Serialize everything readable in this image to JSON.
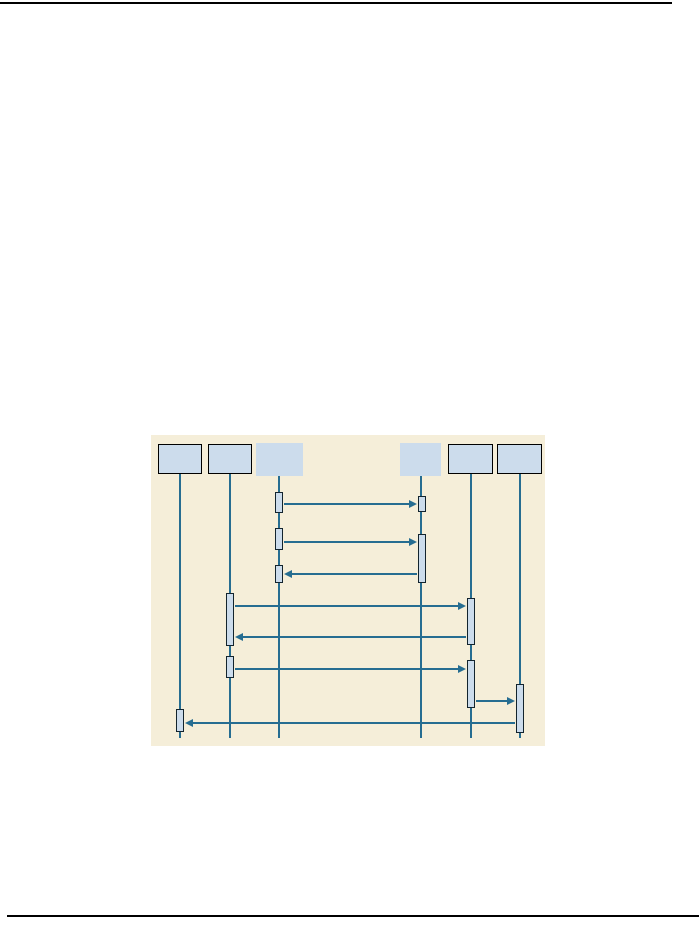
{
  "page": {
    "width": 699,
    "height": 926,
    "background": "#ffffff"
  },
  "page_rules": {
    "top": {
      "x": 0,
      "y": 2,
      "w": 672,
      "h": 2,
      "color": "#000000"
    },
    "bottom": {
      "x": 7,
      "y": 915,
      "w": 692,
      "h": 2,
      "color": "#000000"
    }
  },
  "diagram": {
    "type": "uml-sequence-diagram",
    "panel": {
      "x": 151,
      "y": 435,
      "w": 394,
      "h": 311,
      "bg": "#f5eed9"
    },
    "colors": {
      "box_fill": "#ccdcec",
      "box_border": "#000000",
      "activation_fill": "#ccdcec",
      "activation_border": "#13242e",
      "line": "#266d91"
    },
    "actors": [
      {
        "id": "actor-1",
        "label": "",
        "x": 158,
        "y": 444,
        "w": 44,
        "h": 30,
        "bordered": true
      },
      {
        "id": "actor-2",
        "label": "",
        "x": 208,
        "y": 444,
        "w": 44,
        "h": 30,
        "bordered": true
      },
      {
        "id": "actor-3",
        "label": "",
        "x": 256,
        "y": 443,
        "w": 47,
        "h": 33,
        "bordered": false
      },
      {
        "id": "actor-4",
        "label": "",
        "x": 400,
        "y": 443,
        "w": 41,
        "h": 33,
        "bordered": false
      },
      {
        "id": "actor-5",
        "label": "",
        "x": 448,
        "y": 444,
        "w": 45,
        "h": 30,
        "bordered": true
      },
      {
        "id": "actor-6",
        "label": "",
        "x": 497,
        "y": 444,
        "w": 45,
        "h": 30,
        "bordered": true
      }
    ],
    "lifelines": [
      {
        "actor": 1,
        "x": 180,
        "y1": 474,
        "y2": 738
      },
      {
        "actor": 2,
        "x": 230,
        "y1": 474,
        "y2": 738
      },
      {
        "actor": 3,
        "x": 279,
        "y1": 476,
        "y2": 738
      },
      {
        "actor": 4,
        "x": 421,
        "y1": 476,
        "y2": 738
      },
      {
        "actor": 5,
        "x": 471,
        "y1": 474,
        "y2": 738
      },
      {
        "actor": 6,
        "x": 520,
        "y1": 474,
        "y2": 738
      }
    ],
    "activations": [
      {
        "lifeline": 3,
        "x": 275,
        "y": 492,
        "w": 8,
        "h": 21
      },
      {
        "lifeline": 4,
        "x": 418,
        "y": 496,
        "w": 8,
        "h": 16
      },
      {
        "lifeline": 3,
        "x": 275,
        "y": 528,
        "w": 8,
        "h": 22
      },
      {
        "lifeline": 4,
        "x": 418,
        "y": 534,
        "w": 8,
        "h": 49
      },
      {
        "lifeline": 3,
        "x": 275,
        "y": 565,
        "w": 8,
        "h": 18
      },
      {
        "lifeline": 2,
        "x": 226,
        "y": 593,
        "w": 8,
        "h": 53
      },
      {
        "lifeline": 5,
        "x": 467,
        "y": 598,
        "w": 8,
        "h": 47
      },
      {
        "lifeline": 2,
        "x": 226,
        "y": 656,
        "w": 8,
        "h": 22
      },
      {
        "lifeline": 5,
        "x": 467,
        "y": 660,
        "w": 8,
        "h": 48
      },
      {
        "lifeline": 6,
        "x": 516,
        "y": 684,
        "w": 8,
        "h": 49
      },
      {
        "lifeline": 1,
        "x": 176,
        "y": 709,
        "w": 8,
        "h": 23
      }
    ],
    "messages": [
      {
        "from": 3,
        "to": 4,
        "y": 504,
        "x1": 284,
        "x2": 417,
        "direction": "right"
      },
      {
        "from": 3,
        "to": 4,
        "y": 542,
        "x1": 284,
        "x2": 417,
        "direction": "right"
      },
      {
        "from": 4,
        "to": 3,
        "y": 574,
        "x1": 417,
        "x2": 284,
        "direction": "left"
      },
      {
        "from": 2,
        "to": 5,
        "y": 606,
        "x1": 235,
        "x2": 466,
        "direction": "right"
      },
      {
        "from": 5,
        "to": 2,
        "y": 637,
        "x1": 466,
        "x2": 235,
        "direction": "left"
      },
      {
        "from": 2,
        "to": 5,
        "y": 669,
        "x1": 235,
        "x2": 466,
        "direction": "right"
      },
      {
        "from": 5,
        "to": 6,
        "y": 701,
        "x1": 476,
        "x2": 515,
        "direction": "right"
      },
      {
        "from": 6,
        "to": 1,
        "y": 723,
        "x1": 515,
        "x2": 185,
        "direction": "left"
      }
    ]
  }
}
